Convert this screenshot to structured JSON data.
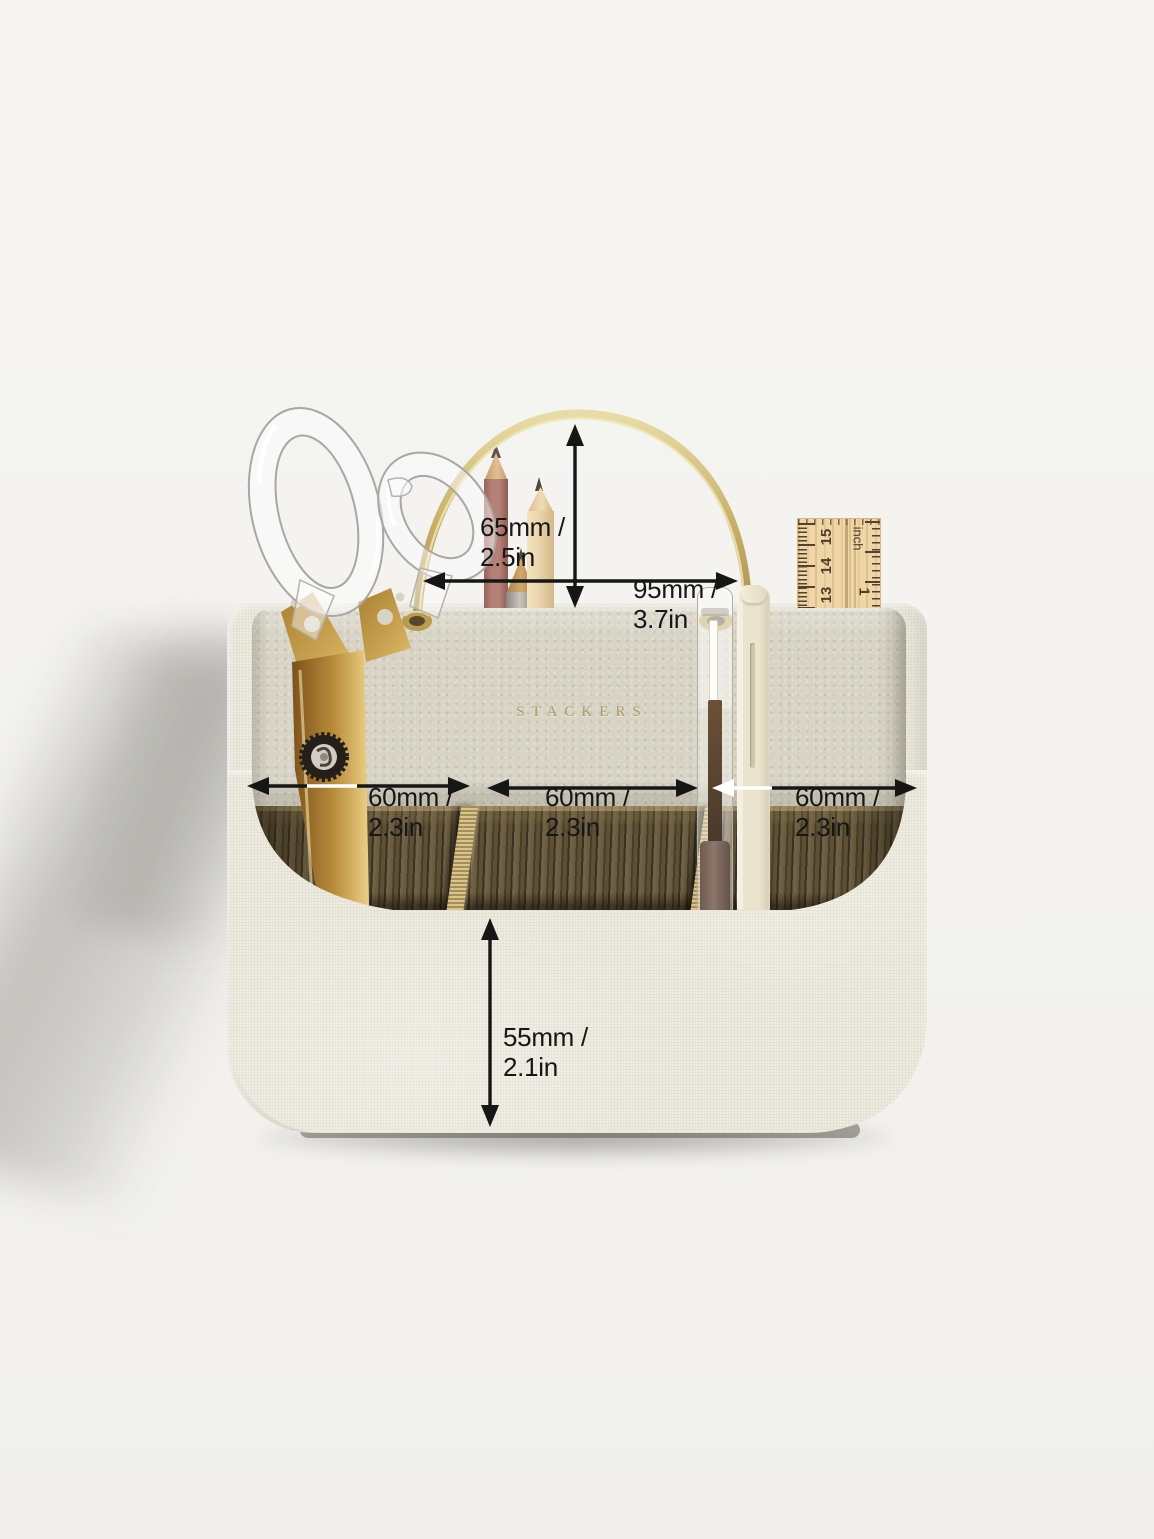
{
  "product": {
    "brand": "STACKERS",
    "type_note": "desk caddy organiser photo with dimension annotations"
  },
  "annotations": {
    "handle_height": {
      "line1": "65mm /",
      "line2": "2.5in"
    },
    "handle_width": {
      "line1": "95mm /",
      "line2": "3.7in"
    },
    "compartment_left": {
      "line1": "60mm /",
      "line2": "2.3in"
    },
    "compartment_middle": {
      "line1": "60mm /",
      "line2": "2.3in"
    },
    "compartment_right": {
      "line1": "60mm /",
      "line2": "2.3in"
    },
    "front_height": {
      "line1": "55mm /",
      "line2": "2.1in"
    }
  },
  "ruler": {
    "cm_marks": [
      "15",
      "14",
      "13"
    ],
    "unit_label": "inch",
    "inch_mark": "1"
  },
  "colors": {
    "background": "#f3f2ef",
    "linen": "#ebe8dc",
    "leather": "#d7d3c5",
    "wood": "#55492f",
    "brass": "#c9b26b",
    "brand_gold": "#ab9868",
    "annotation": "#161616"
  }
}
